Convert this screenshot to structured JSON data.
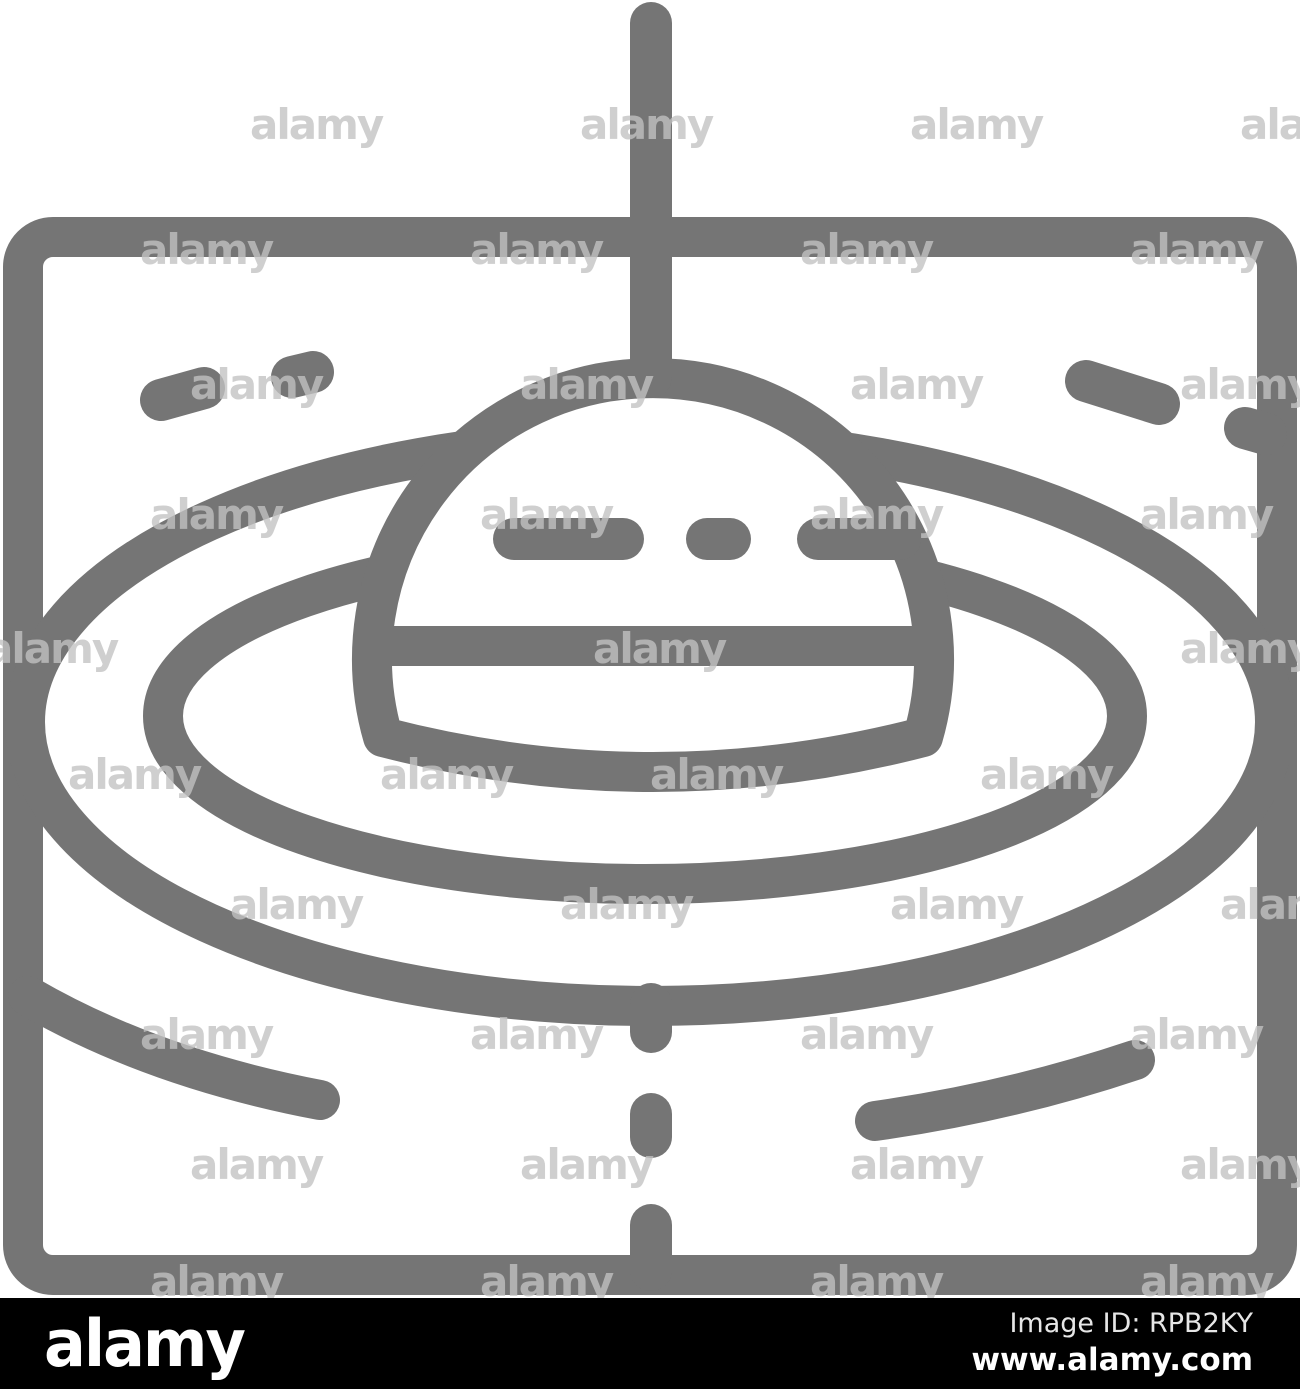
{
  "image": {
    "kind": "stock-photo watermark preview",
    "subject": "Float on water with ripple waves line icon inside square frame"
  },
  "icon": {
    "name": "float-water-ripples-line-icon",
    "stroke_color": "#757575",
    "background_color": "#ffffff"
  },
  "watermark": {
    "text": "alamy",
    "tile_color": "#c2c2c2",
    "tiles": [
      {
        "x": 250,
        "y": 139
      },
      {
        "x": 580,
        "y": 139
      },
      {
        "x": 910,
        "y": 139
      },
      {
        "x": 1240,
        "y": 139
      },
      {
        "x": 140,
        "y": 264
      },
      {
        "x": 470,
        "y": 264
      },
      {
        "x": 800,
        "y": 264
      },
      {
        "x": 1130,
        "y": 264
      },
      {
        "x": 190,
        "y": 399
      },
      {
        "x": 520,
        "y": 399
      },
      {
        "x": 850,
        "y": 399
      },
      {
        "x": 1180,
        "y": 399
      },
      {
        "x": 150,
        "y": 529
      },
      {
        "x": 480,
        "y": 529
      },
      {
        "x": 810,
        "y": 529
      },
      {
        "x": 1140,
        "y": 529
      },
      {
        "x": -15,
        "y": 663
      },
      {
        "x": 593,
        "y": 663
      },
      {
        "x": 1180,
        "y": 663
      },
      {
        "x": 68,
        "y": 789
      },
      {
        "x": 380,
        "y": 789
      },
      {
        "x": 650,
        "y": 789
      },
      {
        "x": 980,
        "y": 789
      },
      {
        "x": 230,
        "y": 919
      },
      {
        "x": 560,
        "y": 919
      },
      {
        "x": 890,
        "y": 919
      },
      {
        "x": 1220,
        "y": 919
      },
      {
        "x": 140,
        "y": 1049
      },
      {
        "x": 470,
        "y": 1049
      },
      {
        "x": 800,
        "y": 1049
      },
      {
        "x": 1130,
        "y": 1049
      },
      {
        "x": 190,
        "y": 1179
      },
      {
        "x": 520,
        "y": 1179
      },
      {
        "x": 850,
        "y": 1179
      },
      {
        "x": 1180,
        "y": 1179
      },
      {
        "x": 150,
        "y": 1296
      },
      {
        "x": 480,
        "y": 1296
      },
      {
        "x": 810,
        "y": 1296
      },
      {
        "x": 1140,
        "y": 1296
      }
    ]
  },
  "bar": {
    "background_color": "#000000",
    "logo": "alamy",
    "logo_color": "#ffffff",
    "image_id": "Image ID: RPB2KY",
    "image_id_color": "#e6e6e6",
    "url": "www.alamy.com",
    "url_color": "#ffffff"
  }
}
